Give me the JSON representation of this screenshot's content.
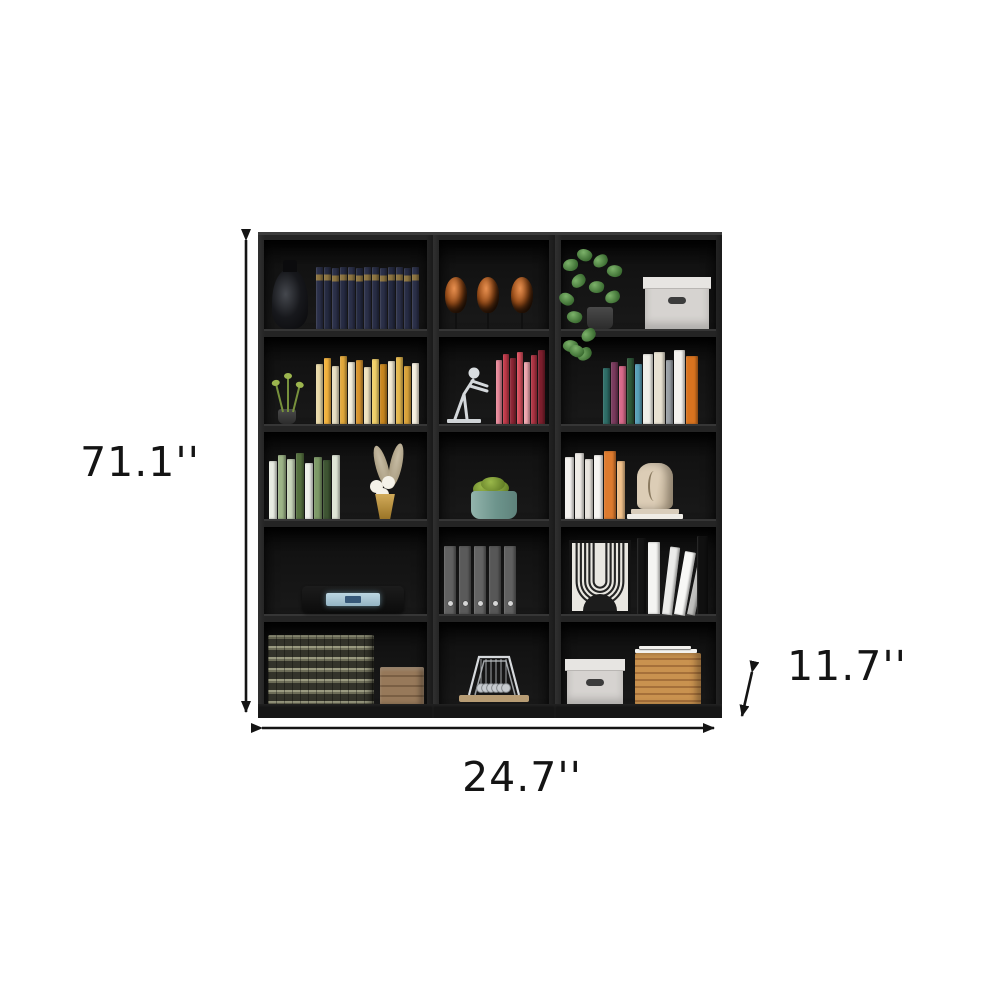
{
  "annotations": {
    "height": {
      "label": "71.1''"
    },
    "width": {
      "label": "24.7''"
    },
    "depth": {
      "label": "11.7''"
    }
  },
  "colors": {
    "background": "#ffffff",
    "furniture_finish": "#1f1f1f",
    "annotation_ink": "#141414"
  },
  "bookcase": {
    "description": "black 5-tier 15-cube bookshelf set, 3 columns x 5 rows",
    "columns": 3,
    "rows": 5,
    "cubbies": [
      {
        "row": 1,
        "col": 1,
        "items": [
          "black glass decanter",
          "set of dark navy encyclopedias with gold bands"
        ]
      },
      {
        "row": 1,
        "col": 2,
        "items": [
          "three copper mask sculptures on stands"
        ]
      },
      {
        "row": 1,
        "col": 3,
        "items": [
          "trailing pothos plant in gray pot",
          "white storage box with handle"
        ]
      },
      {
        "row": 2,
        "col": 1,
        "items": [
          "small green plant in black pot",
          "row of yellow and cream books"
        ]
      },
      {
        "row": 2,
        "col": 2,
        "items": [
          "silver stick-figure bookend",
          "row of red and pink books"
        ]
      },
      {
        "row": 2,
        "col": 3,
        "items": [
          "trailing leaves",
          "row of multicolored books"
        ]
      },
      {
        "row": 3,
        "col": 1,
        "items": [
          "row of green and white books",
          "gold vase with white flowers and pampas grass"
        ]
      },
      {
        "row": 3,
        "col": 2,
        "items": [
          "teal planter with green succulent"
        ]
      },
      {
        "row": 3,
        "col": 3,
        "items": [
          "row of white and orange books",
          "beige abstract face sculpture on stacked books"
        ]
      },
      {
        "row": 4,
        "col": 1,
        "items": [
          "black stereo unit with glowing blue display"
        ]
      },
      {
        "row": 4,
        "col": 2,
        "items": [
          "five gray binders"
        ]
      },
      {
        "row": 4,
        "col": 3,
        "items": [
          "framed black and white arch line art",
          "white and black books"
        ]
      },
      {
        "row": 5,
        "col": 1,
        "items": [
          "stack of vintage encyclopedia volumes",
          "small wooden crate"
        ]
      },
      {
        "row": 5,
        "col": 2,
        "items": [
          "newtons cradle on wooden base"
        ]
      },
      {
        "row": 5,
        "col": 3,
        "items": [
          "white storage box with handle",
          "rattan box topped with papers"
        ]
      }
    ]
  },
  "books": {
    "r1c1": [
      {
        "c": "#2b3049",
        "t": "#8d7440",
        "h": 62
      },
      {
        "c": "#252a40",
        "t": "#8d7440",
        "h": 62
      },
      {
        "c": "#2b3049",
        "t": "#8d7440",
        "h": 61
      },
      {
        "c": "#272c44",
        "t": "#8d7440",
        "h": 62
      },
      {
        "c": "#2b3049",
        "t": "#8d7440",
        "h": 62
      },
      {
        "c": "#242940",
        "t": "#8d7440",
        "h": 61
      },
      {
        "c": "#2b3049",
        "t": "#8d7440",
        "h": 62
      },
      {
        "c": "#282d45",
        "t": "#8d7440",
        "h": 62
      },
      {
        "c": "#2b3049",
        "t": "#8d7440",
        "h": 61
      },
      {
        "c": "#252a41",
        "t": "#8d7440",
        "h": 62
      },
      {
        "c": "#2b3049",
        "t": "#8d7440",
        "h": 62
      },
      {
        "c": "#272c44",
        "t": "#8d7440",
        "h": 61
      },
      {
        "c": "#2b3049",
        "t": "#8d7440",
        "h": 62
      }
    ],
    "r2c1": [
      {
        "c": "#e9d9a8",
        "h": 60
      },
      {
        "c": "#f2b23e",
        "h": 66
      },
      {
        "c": "#e8e0c4",
        "h": 58
      },
      {
        "c": "#e2a93c",
        "h": 68
      },
      {
        "c": "#f5efdc",
        "h": 62
      },
      {
        "c": "#d8952f",
        "h": 64
      },
      {
        "c": "#efe3c0",
        "h": 57
      },
      {
        "c": "#f0d06a",
        "h": 65
      },
      {
        "c": "#c9871f",
        "h": 60
      },
      {
        "c": "#f3ead2",
        "h": 63
      },
      {
        "c": "#e5b84e",
        "h": 67
      },
      {
        "c": "#d9a23a",
        "h": 58
      },
      {
        "c": "#f6f0e0",
        "h": 61
      }
    ],
    "r2c2": [
      {
        "c": "#e8899a",
        "h": 64,
        "w": 6
      },
      {
        "c": "#c23a4a",
        "h": 70,
        "w": 6
      },
      {
        "c": "#8e2635",
        "h": 66,
        "w": 6
      },
      {
        "c": "#d94f5e",
        "h": 72,
        "w": 6
      },
      {
        "c": "#f0a7b0",
        "h": 62,
        "w": 6
      },
      {
        "c": "#b03544",
        "h": 69,
        "w": 6
      },
      {
        "c": "#7e1f2d",
        "h": 74,
        "w": 7
      }
    ],
    "r2c3": [
      {
        "c": "#2f6e68",
        "h": 56
      },
      {
        "c": "#7a3b5e",
        "h": 62
      },
      {
        "c": "#d86a8a",
        "h": 58
      },
      {
        "c": "#2f5a3a",
        "h": 66
      },
      {
        "c": "#58a0b8",
        "h": 60
      },
      {
        "c": "#f0efe9",
        "h": 70,
        "w": 10
      },
      {
        "c": "#e8e2d2",
        "h": 72,
        "w": 11
      },
      {
        "c": "#9aa0a6",
        "h": 64
      },
      {
        "c": "#f4f2ee",
        "h": 74,
        "w": 11
      },
      {
        "c": "#d9731f",
        "h": 68,
        "w": 12
      }
    ],
    "r3c1": [
      {
        "c": "#e8ece2",
        "h": 58,
        "w": 8
      },
      {
        "c": "#9db487",
        "h": 64,
        "w": 8
      },
      {
        "c": "#c9d6bb",
        "h": 60,
        "w": 8
      },
      {
        "c": "#55703f",
        "h": 66,
        "w": 8
      },
      {
        "c": "#eef0ea",
        "h": 56,
        "w": 8
      },
      {
        "c": "#7e9a68",
        "h": 62,
        "w": 8
      },
      {
        "c": "#3e5533",
        "h": 59,
        "w": 8
      },
      {
        "c": "#dfe6d6",
        "h": 64,
        "w": 8
      }
    ],
    "r3c3": [
      {
        "c": "#f4f2ef",
        "h": 62,
        "w": 9
      },
      {
        "c": "#efece7",
        "h": 66,
        "w": 9
      },
      {
        "c": "#e8e4de",
        "h": 60,
        "w": 8
      },
      {
        "c": "#f7f5f2",
        "h": 64,
        "w": 9
      },
      {
        "c": "#dd7a2e",
        "h": 68,
        "w": 12
      },
      {
        "c": "#f0c08a",
        "h": 58,
        "w": 8
      }
    ],
    "r4c2": [
      {
        "c": "#616161",
        "h": 68,
        "w": 12,
        "d": true
      },
      {
        "c": "#5a5a5a",
        "h": 68,
        "w": 12,
        "d": true
      },
      {
        "c": "#636363",
        "h": 68,
        "w": 12,
        "d": true
      },
      {
        "c": "#575757",
        "h": 68,
        "w": 12,
        "d": true
      },
      {
        "c": "#606060",
        "h": 68,
        "w": 12,
        "d": true
      }
    ],
    "r4c3": [
      {
        "c": "#141414",
        "h": 76,
        "w": 9
      },
      {
        "c": "#f4f4f2",
        "h": 72,
        "w": 12
      },
      {
        "c": "#ececea",
        "h": 68,
        "w": 10,
        "r": 7
      },
      {
        "c": "#f8f8f6",
        "h": 64,
        "w": 11,
        "r": 10
      },
      {
        "c": "#bfbfbd",
        "h": 60,
        "w": 8,
        "r": 12
      },
      {
        "c": "#101010",
        "h": 78,
        "w": 11
      }
    ]
  }
}
